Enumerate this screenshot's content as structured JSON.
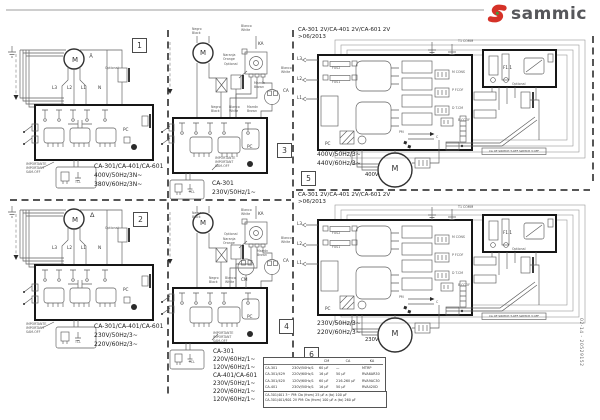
{
  "logo": {
    "brand": "sammic"
  },
  "doc_code": "02-14 - 20529152",
  "wire_colors": {
    "negro": [
      "Negro",
      "Black"
    ],
    "blanco": [
      "Blanco",
      "White"
    ],
    "marron": [
      "Marrón",
      "Brown"
    ],
    "naranja": [
      "Naranja",
      "Orange"
    ]
  },
  "panels": {
    "p1": {
      "number": "1",
      "phase_symbol": "Y",
      "motor": "M",
      "terminals": [
        "L3",
        "L2",
        "L1",
        "N"
      ],
      "optional": "Optional",
      "pc": "PC",
      "important": [
        "IMPORTANTE",
        "IMPORTANT",
        "SAM-OFF"
      ],
      "plug": "TCL",
      "caption": [
        "CA-301/CA-401/CA-601",
        "400V/50Hz/3N~",
        "380V/60Hz/3N~"
      ]
    },
    "p2": {
      "number": "2",
      "phase_symbol": "Δ",
      "motor": "M",
      "terminals": [
        "L3",
        "L2",
        "L1",
        "N"
      ],
      "optional": "Optional",
      "pc": "PC",
      "important": [
        "IMPORTANTE",
        "IMPORTANT",
        "SAM-OFF"
      ],
      "plug": "TCL",
      "caption": [
        "CA-301/CA-401/CA-601",
        "230V/50Hz/3~",
        "220V/60Hz/3~"
      ]
    },
    "p3": {
      "number": "3",
      "motor": "M",
      "switch_label": "KA",
      "cap_label": "CA",
      "optional": "Optional",
      "pc": "PC",
      "important": [
        "IMPORTANTE",
        "IMPORTANT",
        "SAM-OFF"
      ],
      "plug": "TCL",
      "caption": [
        "CA-301",
        "230V/50Hz/1~"
      ]
    },
    "p4": {
      "number": "4",
      "motor": "M",
      "switch_label": "KA",
      "cap1_label": "CM",
      "cap2_label": "CA",
      "optional": "Optional",
      "pc": "PC",
      "important": [
        "IMPORTANTE",
        "IMPORTANT",
        "SAM-OFF"
      ],
      "plug": "TCL",
      "caption": [
        "CA-301",
        "220V/60Hz/1~",
        "120V/60Hz/1~",
        "CA-401/CA-601",
        "230V/50Hz/1~",
        "220V/60Hz/1~",
        "120V/60Hz/1~"
      ]
    },
    "p5": {
      "number": "5",
      "header": [
        "CA-301 2V/CA-401 2V/CA-601 2V",
        ">06/2013"
      ],
      "caption": [
        "400V/50Hz/3~",
        "440V/60Hz/3~"
      ],
      "motor": "M",
      "motor_voltage": "400V",
      "inputs": [
        "L3",
        "L2",
        "L1"
      ],
      "fuses": [
        "FUS2",
        "FUS1"
      ],
      "ground_label": "T1 COMM",
      "connectors": [
        "M CONS",
        "P FCOF",
        "D T.CM",
        "B CCOF"
      ],
      "pm_label": "PM",
      "c_label": "C",
      "fuse2_label": "F1.1",
      "optional": "Optional",
      "pc": "PC",
      "switch_strip": "CA OF SWITCH T-OFF SWITCH 3 OFF"
    },
    "p6": {
      "number": "6",
      "header": [
        "CA-301 2V/CA-401 2V/CA-601 2V",
        ">06/2013"
      ],
      "caption": [
        "230V/50Hz/3~",
        "220V/60Hz/3~"
      ],
      "motor": "M",
      "motor_voltage": "230V",
      "inputs": [
        "L3",
        "L2",
        "L1"
      ],
      "fuses": [
        "FUS2",
        "FUS1"
      ],
      "ground_label": "T1 COMM",
      "connectors": [
        "M CONS",
        "P FCOF",
        "D T.CM",
        "B CCOF"
      ],
      "pm_label": "PM",
      "c_label": "C",
      "fuse2_label": "F1.1",
      "optional": "Optional",
      "pc": "PC",
      "switch_strip": "CA OF SWITCH T-OFF SWITCH 3 OFF"
    }
  },
  "table": {
    "headers": [
      "CM",
      "CA",
      "KA"
    ],
    "rows": [
      [
        "CA-301",
        "230V/50Hz/1",
        "60 µF",
        "—",
        "MTRP"
      ],
      [
        "CA-301/429",
        "220V/60Hz/1",
        "16 µF",
        "50 µF",
        "RVA6AR30"
      ],
      [
        "CA-301/420",
        "120V/60Hz/1",
        "60 µF",
        "216-260 µF",
        "RVA9AC30"
      ],
      [
        "CA-401",
        "230V/50Hz/1",
        "16 µF",
        "50 µF",
        "RVA420D"
      ]
    ],
    "notes": [
      "CA-301/401 3~ PM: Da (from) 25 µF a (to) 100 µF",
      "CA-301/401/601 2V PM: Da (from) 100 µF a (to) 260 µF"
    ]
  }
}
